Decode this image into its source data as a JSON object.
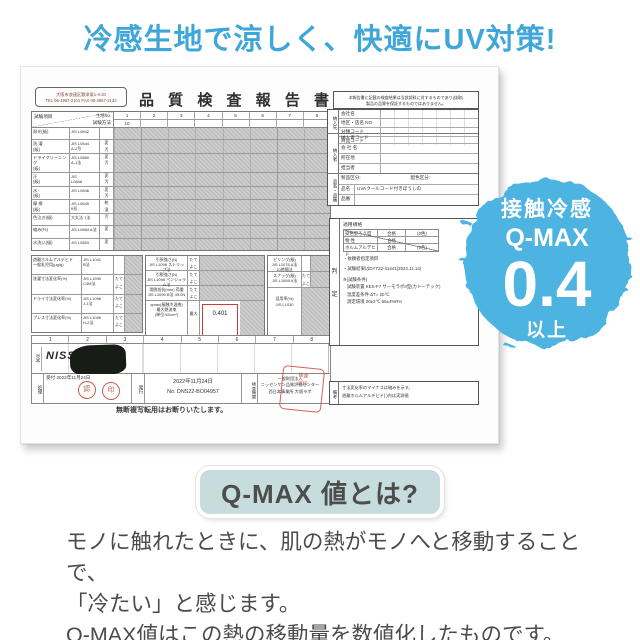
{
  "colors": {
    "accent_blue": "#3fa6d9",
    "badge_blue": "#4db3e0",
    "button_bg": "#c7dddd",
    "stamp_red": "#c53c2b",
    "value_box_red": "#cf3a30",
    "text_gray": "#4b4b4b"
  },
  "headline": "冷感生地で涼しく、快適にUV対策!",
  "badge": {
    "line1": "接触冷感",
    "line2": "Q-MAX",
    "value": "0.4",
    "line3": "以上"
  },
  "qmax_section": {
    "heading": "Q-MAX 値とは?",
    "description_lines": [
      "モノに触れたときに、肌の熱がモノへと移動することで、",
      "「冷たい」と感じます。",
      "Q-MAX値はこの熱の移動量を数値化したものです。"
    ]
  },
  "report": {
    "title": "品 質 検 査 報 告 書",
    "lab_address": "大阪市浪速区敷津東1-4-20\nTEL 06-4957-2101 FAX 06-4957-2133",
    "header": {
      "item_label": "試験項目",
      "method_label": "試験方法",
      "sample_no_label": "生地No.",
      "columns": [
        "1",
        "2",
        "3",
        "4",
        "5",
        "6",
        "7",
        "8"
      ],
      "sample_no_value": "10"
    },
    "test_rows": [
      {
        "name": "耐光(級)",
        "method": "JIS L0842",
        "mods": ""
      },
      {
        "name": "洗 濯\n(級)",
        "method": "JIS L0844\nA-2号",
        "mods": "変\n汚"
      },
      {
        "name": "ドライクリーニング\n(級)",
        "method": "JIS L0860\nA-1法",
        "mods": "変\n汚"
      },
      {
        "name": "汗\n(級)",
        "method": "JIS\nL0848",
        "mods": "変\n汚"
      },
      {
        "name": "水\n(級)",
        "method": "JIS L0846",
        "mods": "変\n汚"
      },
      {
        "name": "摩 擦\n(級)",
        "method": "JIS L0849\nII形",
        "mods": "乾\n湿"
      },
      {
        "name": "色泣き(級)",
        "method": "大丸法 1法",
        "mods": "汚"
      },
      {
        "name": "縮み(%)",
        "method": "JIS L0884 A法",
        "mods": "変"
      },
      {
        "name": "水洗い(級)",
        "method": "JIS L0853",
        "mods": "変"
      }
    ],
    "dim_rows": [
      {
        "name": "遊離ホルムアルデヒド\n一般乳児用(μg/g)",
        "method": "JIS L1041\nB法",
        "mods": ""
      },
      {
        "name": "洗濯寸法変化率(%)",
        "method": "JIS L1930\nC4M法",
        "mods": "たて\nよこ"
      },
      {
        "name": "ドライ寸法変化率(%)",
        "method": "JIS L1096\nJ-1法",
        "mods": "たて\nよこ"
      },
      {
        "name": "プレス寸法変化率(%)",
        "method": "JIS L1096\nH-2法",
        "mods": "たて\nよこ"
      }
    ],
    "strength_rows": [
      {
        "name": "引張強さ(N)\nJIS L1096 ストリップ法",
        "mods": "たて\nよこ"
      },
      {
        "name": "引裂強さ(N)\nJIS L1096 ペンジュラム法",
        "mods": "たて\nよこ"
      },
      {
        "name": "滑脱抵抗(mm) 荷重\nJIS L1096 B法 49.0N",
        "mods": "たて\nよこ"
      }
    ],
    "qmax": {
      "label": "qmax(接触冷温感)\n最大熱流束\n(単位:W/cm²)",
      "max_label": "最大",
      "value": "0.401"
    },
    "blend": {
      "label": "混用率(%)\nJIS L1030"
    },
    "surface_rows": [
      {
        "name": "ピリング(級)\nJIS L1076 A法 10時間法",
        "mods": ""
      },
      {
        "name": "スナッグ(級)\nJIS L1058 A法",
        "mods": "たて\nよこ"
      }
    ],
    "footer_numbers": [
      "1",
      "2",
      "3",
      "4",
      "5",
      "6",
      "7",
      "8"
    ],
    "specimen_label": "見本",
    "logo_text": "NISSENKEN",
    "handling_label": "処理",
    "receipt": {
      "label": "受付",
      "date": "2022年11月24日",
      "stamp1": "認",
      "stamp2": "印"
    },
    "issue": {
      "label": "発行",
      "date": "2022年11月24日",
      "number": "No.  DNS22-BO04957"
    },
    "agency": {
      "label": "検査機関",
      "name": "一般財団法人\nニッセンケン品質評価センター\n西日本事業所 大阪ラボ"
    },
    "big_stamp_text": "検査\n済印",
    "copyright_note": "無断複写転用はお断りいたします。",
    "right": {
      "notice": "本報告書に記載の検査結果は当該試料に対するものであり(抜取)\n製品の品質を保証するものではありません。",
      "buyer": {
        "label": "納入先",
        "rows": [
          "会社名",
          "地区・店名 NO",
          "分類コード",
          "商品コード"
        ]
      },
      "supplier": {
        "label": "納入者",
        "rows": [
          "納入者コード",
          "会 社 名",
          "所在地",
          "担当者"
        ]
      },
      "product": {
        "label": "品名・品番",
        "division": "製品区分:",
        "color_division": "配色区分:",
        "name_label": "品名",
        "name": "UVAクールコード付きぼうしの",
        "code_label": "品番"
      },
      "standard": {
        "title": "適用規格",
        "rows": [
          {
            "k": "染色堅ろう度",
            "v": "合格",
            "n": "(0色)"
          },
          {
            "k": "物 性",
            "v": "合格",
            "n": ""
          },
          {
            "k": "ホルムアルデヒド",
            "v": "合格",
            "n": "(0色)"
          }
        ],
        "designated": "・依頼者指定項目",
        "result_note": "・試験結果はDYT22-41441(2022.11.14)",
        "cond_title": "※(試験条件)",
        "cond_lines": [
          "試験装置 KES-F7 サーモラボII型(カトーテック)",
          "温度差条件 ΔT= 20℃",
          "測定環境 20±2℃ 65±4%RH"
        ],
        "judgement": [
          "判",
          "定"
        ]
      },
      "remarks": {
        "label": "備考",
        "text": "寸法変化率のマイナスは縮みを示す。\n遊離ホルムアルデヒド( )内は実測値"
      }
    }
  }
}
